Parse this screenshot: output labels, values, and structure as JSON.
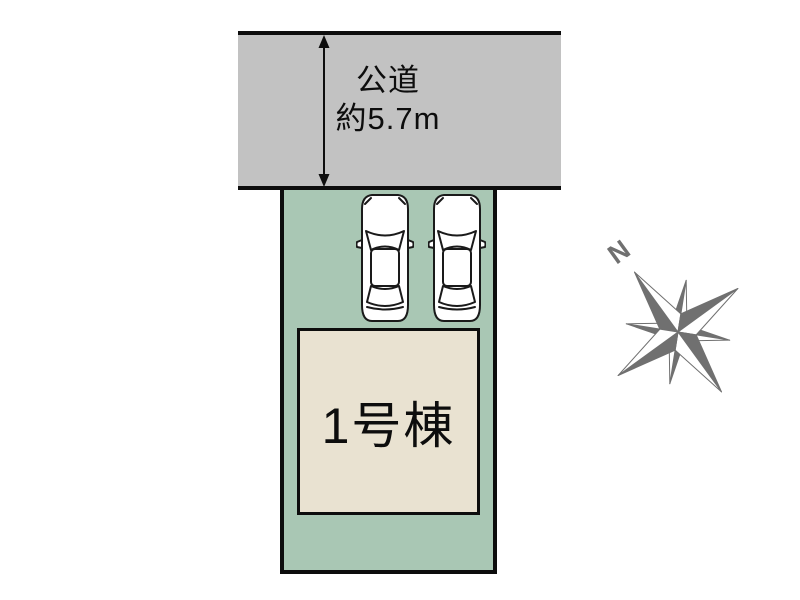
{
  "diagram": {
    "background_color": "#ffffff"
  },
  "road": {
    "label_line1": "公道",
    "label_line2": "約5.7m",
    "fill_color": "#c2c2c2",
    "outline_color": "#0d0d0d"
  },
  "plot": {
    "fill_color": "#a9c7b4",
    "outline_color": "#0d0d0d",
    "cars_parked": 2
  },
  "building": {
    "label": "1号棟",
    "fill_color": "#e9e2d1",
    "outline_color": "#0d0d0d"
  },
  "car": {
    "body_color": "#ffffff",
    "outline_color": "#1a1a1a"
  },
  "compass": {
    "north_label": "N",
    "color": "#707070"
  }
}
